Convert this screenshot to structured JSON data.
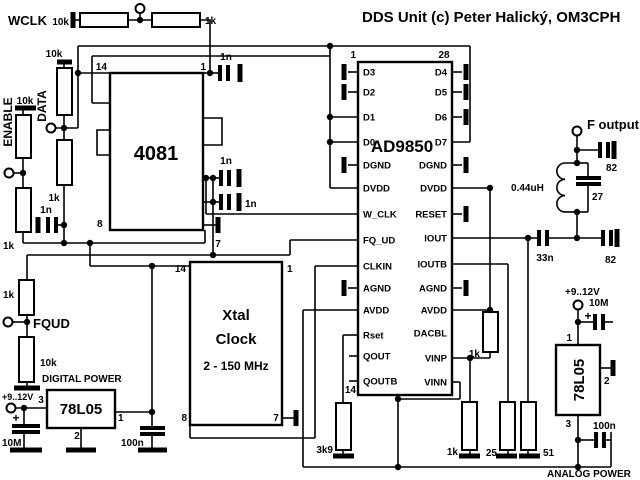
{
  "title": "DDS Unit (c) Peter Halický, OM3CPH",
  "inputs": {
    "wclk": {
      "label": "WCLK",
      "pull": "10k",
      "series": "1k"
    },
    "data": {
      "label": "DATA",
      "pull": "10k",
      "series": "1k",
      "cap": "1n"
    },
    "enable": {
      "label": "ENABLE",
      "pull": "10k",
      "series": "1k"
    },
    "fqud": {
      "label": "FQUD",
      "series": "1k",
      "pull": "10k"
    }
  },
  "gate": {
    "name": "4081",
    "pin14": "14",
    "pin1": "1",
    "pin8": "8",
    "pin7": "7",
    "cap_pin1": "1n",
    "cap_wclk": "1n",
    "cap_fqud": "1n"
  },
  "dds": {
    "name": "AD9850",
    "pin1": "1",
    "pin28": "28",
    "pin14": "14",
    "left": [
      "D3",
      "D2",
      "D1",
      "D0",
      "DGND",
      "DVDD",
      "W_CLK",
      "FQ_UD",
      "CLKIN",
      "AGND",
      "AVDD",
      "Rset",
      "QOUT",
      "QOUTB"
    ],
    "right": [
      "D4",
      "D5",
      "D6",
      "D7",
      "DGND",
      "DVDD",
      "RESET",
      "IOUT",
      "IOUTB",
      "AGND",
      "AVDD",
      "DACBL",
      "VINP",
      "VINN"
    ],
    "rset_r": "3k9",
    "vinp_load": "1k",
    "vinp_bias": "1k",
    "ioutb_load": "25",
    "iout_load": "51"
  },
  "xtal": {
    "l1": "Xtal",
    "l2": "Clock",
    "l3": "2 - 150 MHz",
    "pin14": "14",
    "pin1": "1",
    "pin8": "8",
    "pin7": "7"
  },
  "output": {
    "label": "F output",
    "coupling": "33n",
    "cap_top": "82",
    "cap_bottom": "82",
    "tank_cap": "27",
    "inductor": "0.44uH"
  },
  "power_digital": {
    "section": "DIGITAL POWER",
    "reg": "78L05",
    "vin": "+9..12V",
    "pin3": "3",
    "pin1": "1",
    "pin2": "2",
    "cin": "10M",
    "cout": "100n",
    "plus": "+"
  },
  "power_analog": {
    "section": "ANALOG POWER",
    "reg": "78L05",
    "vin": "+9..12V",
    "pin1": "1",
    "pin2": "2",
    "pin3": "3",
    "cin": "10M",
    "cout": "100n",
    "plus": "+"
  }
}
